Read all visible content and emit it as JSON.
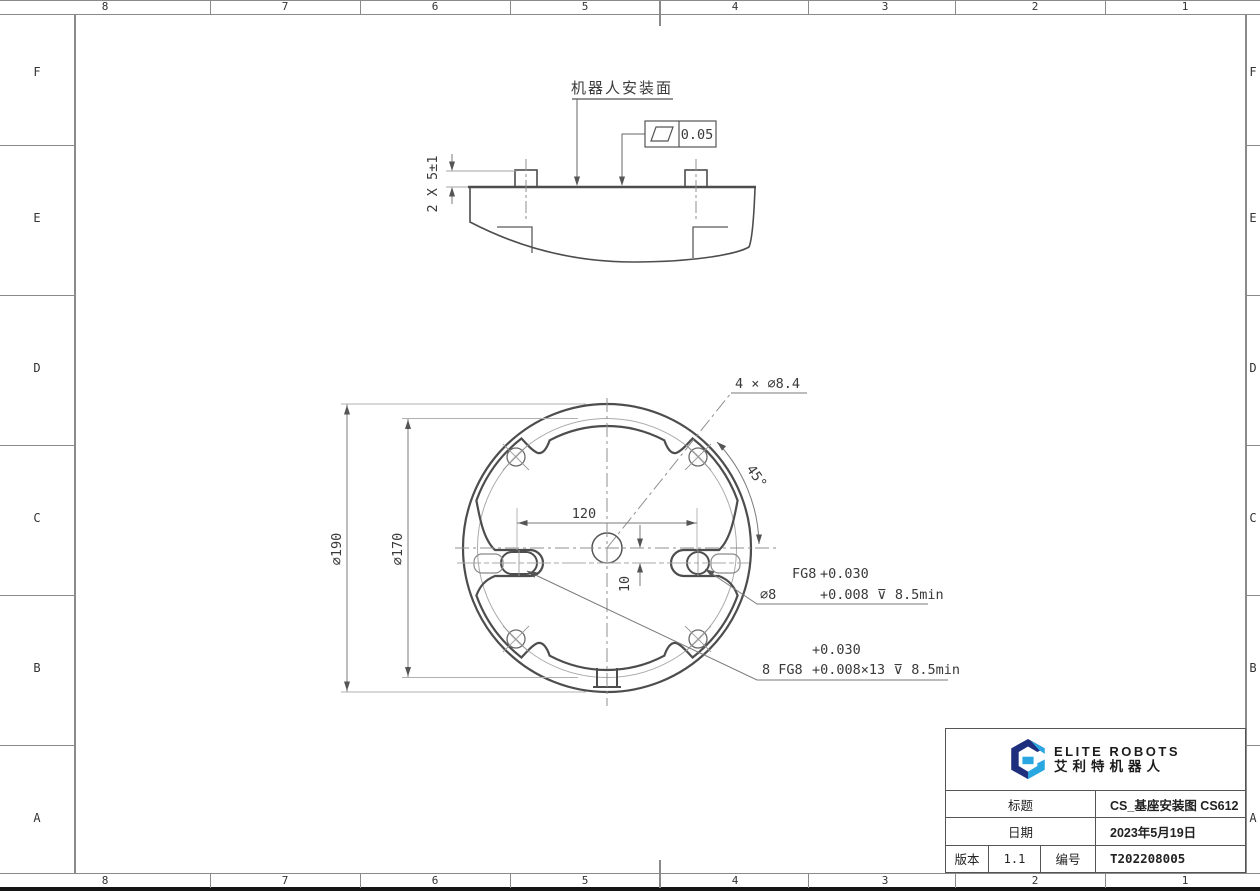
{
  "sheet": {
    "cols": [
      "8",
      "7",
      "6",
      "5",
      "4",
      "3",
      "2",
      "1"
    ],
    "rows": [
      "F",
      "E",
      "D",
      "C",
      "B",
      "A"
    ]
  },
  "side_view": {
    "surface_label": "机器人安装面",
    "flatness_value": "0.05",
    "pins_dim": "2 X 5±1"
  },
  "plan_view": {
    "holes_label": "4 × ⌀8.4",
    "angle_dim": "45°",
    "outer_dia": "⌀190",
    "bolt_circle_dia": "⌀170",
    "spacing_dim": "120",
    "offset_dim": "10",
    "pin_fit": {
      "grade": "FG8",
      "upper": "+0.030",
      "size": "⌀8",
      "lower": "+0.008 ⊽ 8.5min"
    },
    "thread_fit": {
      "upper": "+0.030",
      "prefix": "8 FG8",
      "lower": "+0.008×13 ⊽ 8.5min"
    }
  },
  "title_block": {
    "brand_en": "ELITE ROBOTS",
    "brand_cn": "艾利特机器人",
    "title_label": "标题",
    "title_value": "CS_基座安装图 CS612",
    "date_label": "日期",
    "date_value": "2023年5月19日",
    "version_label": "版本",
    "version_value": "1.1",
    "number_label": "编号",
    "number_value": "T202208005"
  },
  "colors": {
    "accent_navy": "#1e2f7d",
    "accent_blue": "#2aa7e0",
    "line": "#4d4d4d",
    "thin_line": "#a3a3a3"
  }
}
